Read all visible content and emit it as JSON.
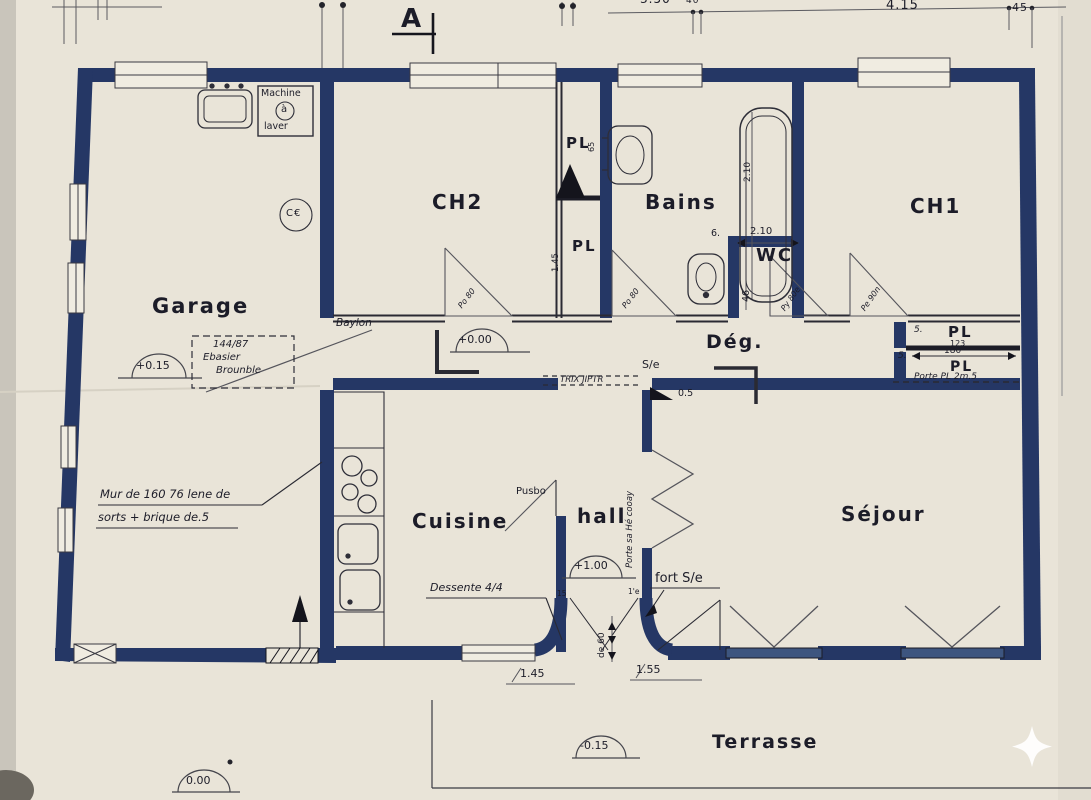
{
  "colors": {
    "paper": "#e9e4d8",
    "wall": "#253765",
    "ink": "#1c1c28",
    "thin_line": "#4b4b52"
  },
  "section_marker": "A",
  "top_dims": {
    "d1": "3.50",
    "d2": "40",
    "d3": "4.15",
    "d4": "45"
  },
  "rooms": {
    "garage": "Garage",
    "ch2": "CH2",
    "bains": "Bains",
    "wc": "WC",
    "ch1": "CH1",
    "deg": "Dég.",
    "cuisine": "Cuisine",
    "hall": "hall",
    "sejour": "Séjour",
    "terrasse": "Terrasse"
  },
  "machine": {
    "l1": "Machine",
    "l2": "à",
    "l3": "laver"
  },
  "levels": {
    "garage": "+0.15",
    "corridor": "+0.00",
    "hall": "+1.00",
    "terrace": "-0.15",
    "ground": "0.00"
  },
  "cadastre": {
    "l1": "144/87",
    "l2": "Ebasier",
    "l3": "Brounble"
  },
  "wall_note": {
    "l1": "Mur de 160 76 lene de",
    "l2": "sorts + brique de.5"
  },
  "closets": {
    "pl_top": "PL",
    "pl_top_dim": "65",
    "pl_mid": "PL",
    "pl_mid_dim": "1.45",
    "pl_ch1_a": "PL",
    "pl_ch1_a_num": "123",
    "pl_ch1_a_off": "5.",
    "pl_ch1_b": "PL",
    "pl_ch1_b_dim": "180",
    "pl_ch1_b_off": "5.",
    "pl_door_note": "Porte PL 2m.5"
  },
  "doors": {
    "baylon": "Baylon",
    "ch2": "Po 80",
    "bains": "Po 80",
    "wc": "Py 80e",
    "ch1": "Pe 90n",
    "cuisine": "Pusbo",
    "hall_sejour": "Porte sa Hé cooay",
    "sejour_terrace": "fort S/e",
    "floor_note": "TRIX JIPTR",
    "se": "S/e",
    "step": "0.5"
  },
  "dims": {
    "bath": "2.10",
    "wc_w": "2.10",
    "wc_gap": "6.",
    "wc_d": "46",
    "door_a": "1.45",
    "door_b": "1.55",
    "step": "de 60",
    "tick_a": "15",
    "tick_b": "1'e"
  },
  "notes": {
    "dessente": "Dessente 4/4",
    "ce": "C€"
  }
}
